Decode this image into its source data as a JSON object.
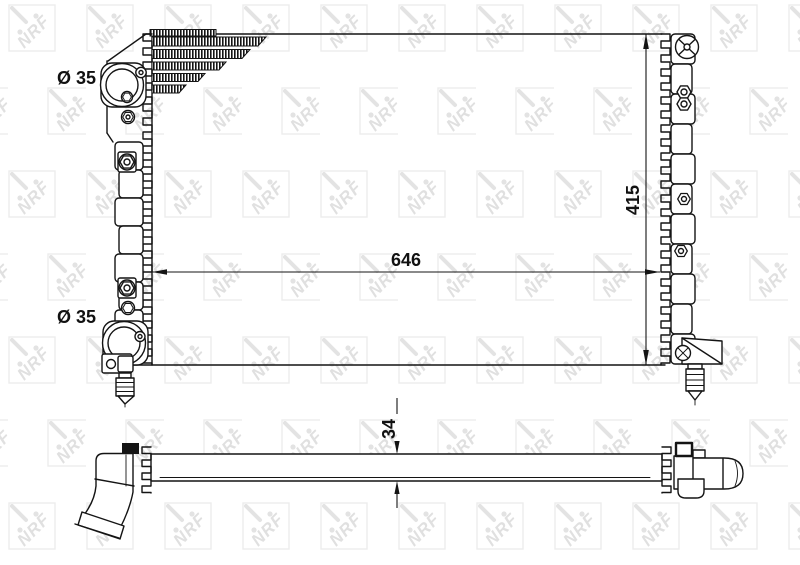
{
  "colors": {
    "ink": "#141414",
    "watermark": "#e3e3e3",
    "background": "#ffffff"
  },
  "watermark": {
    "text": "NRF"
  },
  "front_view": {
    "labels": {
      "top_port_diameter": "Ø 35",
      "bottom_port_diameter": "Ø 35",
      "core_width": "646",
      "core_height": "415"
    }
  },
  "bottom_view": {
    "labels": {
      "core_thickness": "34"
    }
  }
}
